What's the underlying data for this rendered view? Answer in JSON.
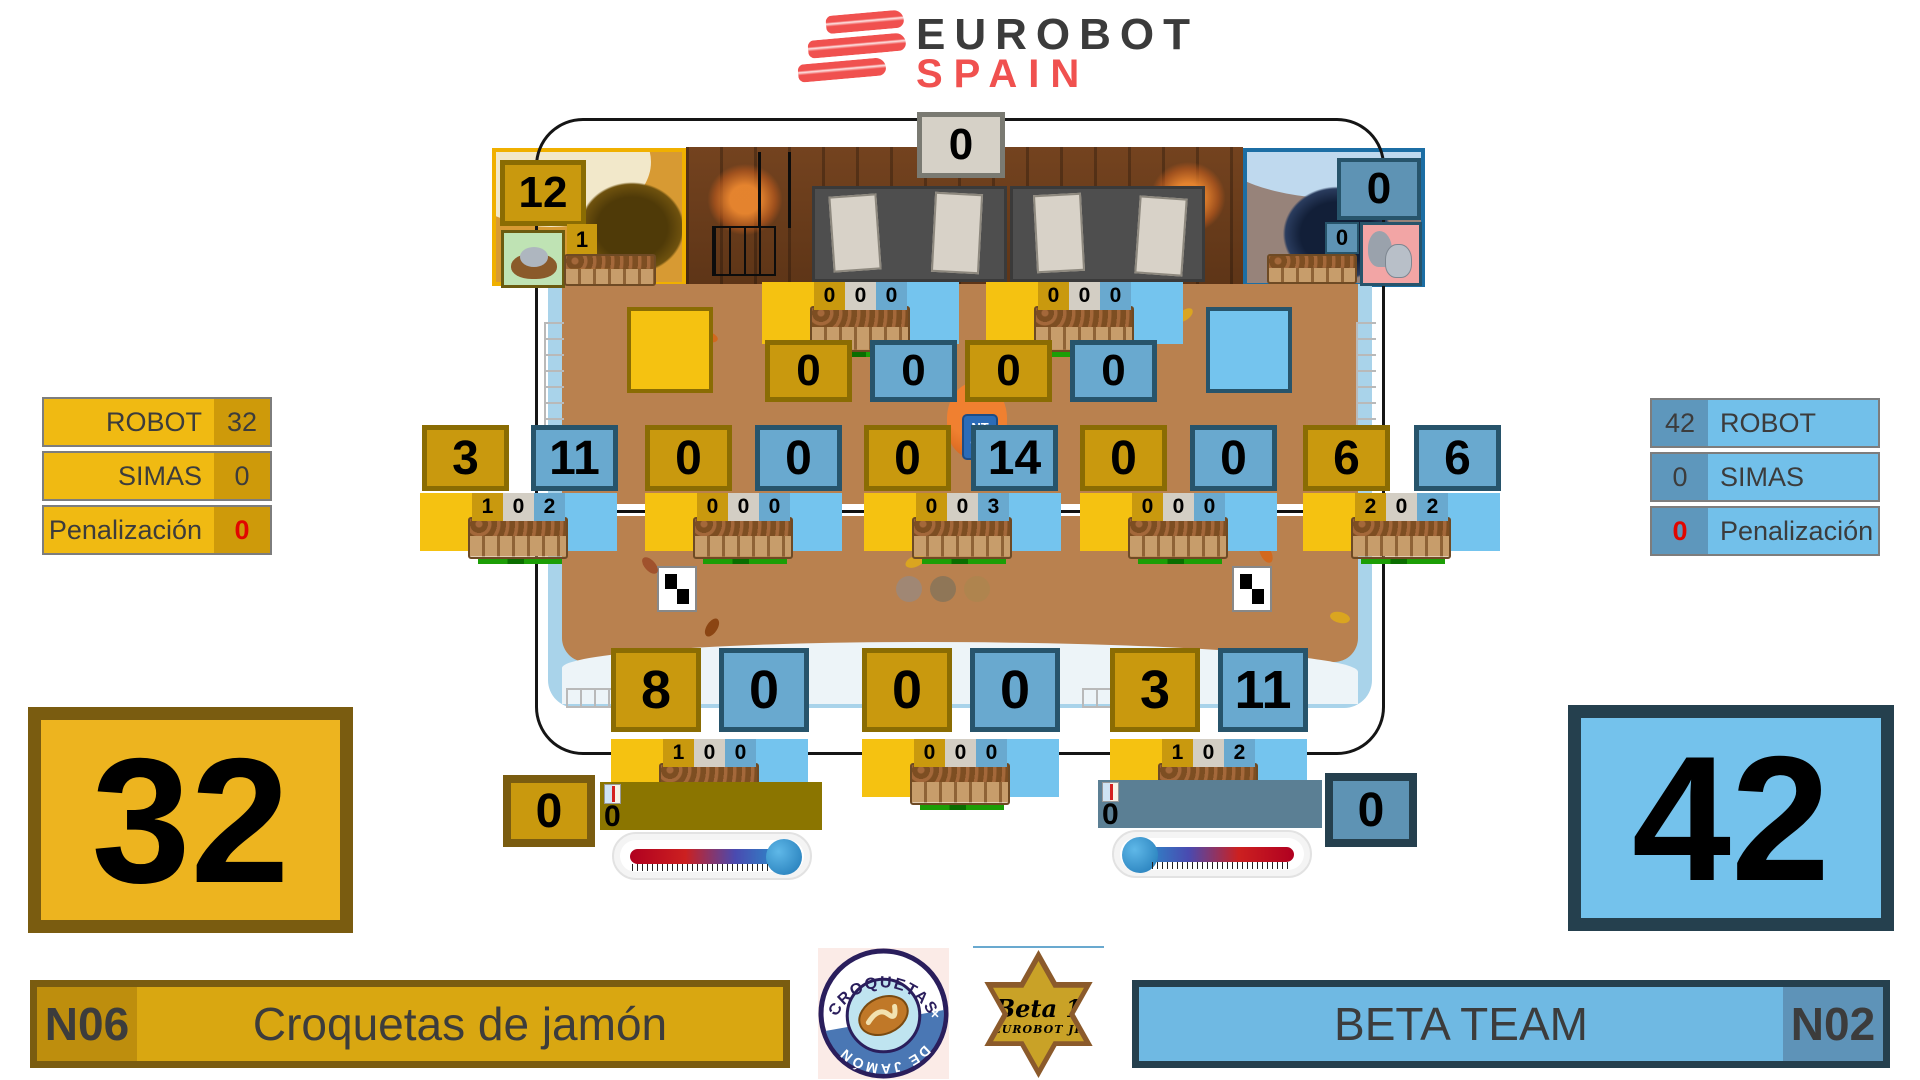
{
  "header": {
    "brand_primary": "EUROBOT",
    "brand_secondary": "SPAIN"
  },
  "left_panel": {
    "rows": [
      {
        "label": "ROBOT",
        "value": "32"
      },
      {
        "label": "SIMAS",
        "value": "0"
      },
      {
        "label": "Penalización",
        "value": "0"
      }
    ]
  },
  "right_panel": {
    "rows": [
      {
        "label": "ROBOT",
        "value": "42"
      },
      {
        "label": "SIMAS",
        "value": "0"
      },
      {
        "label": "Penalización",
        "value": "0"
      }
    ]
  },
  "totals": {
    "left": "32",
    "right": "42"
  },
  "teams": {
    "left": {
      "code": "N06",
      "name": "Croquetas de jamón"
    },
    "right": {
      "code": "N02",
      "name": "BETA TEAM"
    }
  },
  "field": {
    "top_left_score": "12",
    "top_left_nest_count": "1",
    "top_center_score": "0",
    "top_right_score": "0",
    "top_right_small_score": "0",
    "upper_boxes": [
      "0",
      "0",
      "0",
      "0"
    ],
    "upper_planter_cells": [
      [
        "0",
        "0",
        "0"
      ],
      [
        "0",
        "0",
        "0"
      ]
    ],
    "mid_boxes": [
      "3",
      "11",
      "0",
      "0",
      "0",
      "14",
      "0",
      "0",
      "6",
      "6"
    ],
    "mid_planter_cells": [
      [
        "1",
        "0",
        "2"
      ],
      [
        "0",
        "0",
        "0"
      ],
      [
        "0",
        "0",
        "3"
      ],
      [
        "0",
        "0",
        "0"
      ],
      [
        "2",
        "0",
        "2"
      ]
    ],
    "bottom_boxes": [
      "8",
      "0",
      "0",
      "0",
      "3",
      "11"
    ],
    "bottom_planter_cells": [
      [
        "1",
        "0",
        "0"
      ],
      [
        "0",
        "0",
        "0"
      ],
      [
        "1",
        "0",
        "2"
      ]
    ],
    "left_tray_score": "0",
    "left_bar_value": "0",
    "right_tray_score": "0",
    "right_bar_value": "0",
    "center_sign": [
      "NT",
      "ON"
    ]
  },
  "badges": {
    "croquetas": {
      "top": "CROQUETAS",
      "bottom": "DE JAMÓN"
    },
    "beta": {
      "line1": "Beta 1",
      "line2": "EUROBOT JR"
    }
  },
  "colors": {
    "team_left_accent": "#EDB41F",
    "team_left_dark": "#7A5C10",
    "team_right_accent": "#74C2EC",
    "team_right_dark": "#25404E",
    "score_gold": "#C9990E",
    "score_blue": "#69A9CF",
    "penalty_red": "#E10600",
    "brand_red": "#F0514F"
  }
}
